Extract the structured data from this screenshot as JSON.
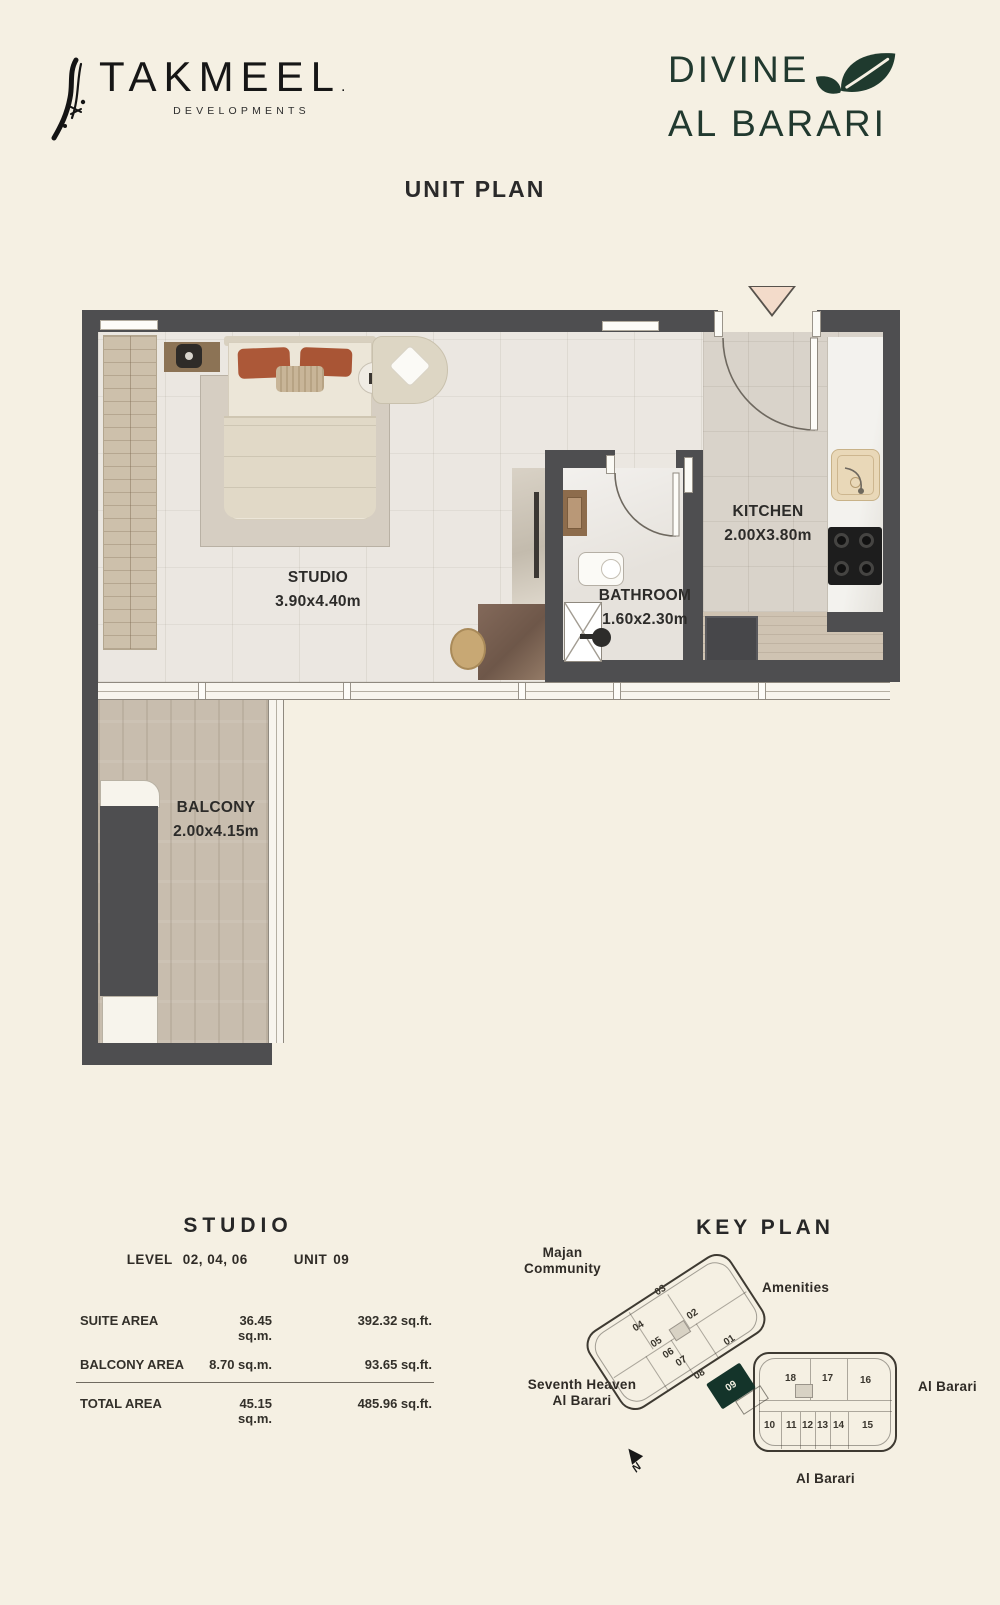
{
  "header": {
    "brand_name": "TAKMEEL",
    "brand_trademark": ".",
    "brand_sub": "DEVELOPMENTS",
    "project_line1": "DIVINE",
    "project_line2": "AL BARARI",
    "page_title": "UNIT PLAN"
  },
  "floor_plan": {
    "rooms": {
      "studio": {
        "name": "STUDIO",
        "dims": "3.90x4.40m"
      },
      "bathroom": {
        "name": "BATHROOM",
        "dims": "1.60x2.30m"
      },
      "kitchen": {
        "name": "KITCHEN",
        "dims": "2.00X3.80m"
      },
      "balcony": {
        "name": "BALCONY",
        "dims": "2.00x4.15m"
      }
    }
  },
  "unit_info": {
    "type": "STUDIO",
    "level_label": "LEVEL",
    "level_values": "02, 04, 06",
    "unit_label": "UNIT",
    "unit_value": "09",
    "areas": [
      {
        "label": "SUITE AREA",
        "sqm": "36.45 sq.m.",
        "sqft": "392.32 sq.ft."
      },
      {
        "label": "BALCONY AREA",
        "sqm": "8.70 sq.m.",
        "sqft": "93.65 sq.ft."
      },
      {
        "label": "TOTAL AREA",
        "sqm": "45.15 sq.m.",
        "sqft": "485.96 sq.ft."
      }
    ]
  },
  "key_plan": {
    "title": "KEY PLAN",
    "labels": {
      "majan_line1": "Majan",
      "majan_line2": "Community",
      "amenities": "Amenities",
      "seventh_line1": "Seventh Heaven",
      "seventh_line2": "Al Barari",
      "al_barari_right": "Al Barari",
      "al_barari_bottom": "Al Barari",
      "north": "N"
    },
    "highlighted_unit": "09",
    "building_a_units": [
      "01",
      "02",
      "03",
      "04",
      "05",
      "06",
      "07",
      "08"
    ],
    "building_b_units": [
      "10",
      "11",
      "12",
      "13",
      "14",
      "15",
      "16",
      "17",
      "18"
    ]
  },
  "colors": {
    "background": "#f5f0e3",
    "wall": "#4e4e50",
    "accent_green": "#1f3a2e",
    "highlight_unit": "#14342a",
    "pillow_rust": "#ac5838"
  }
}
